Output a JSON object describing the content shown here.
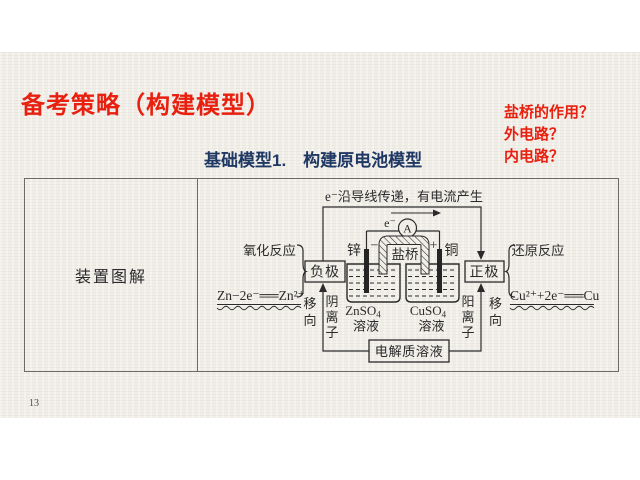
{
  "header": {
    "title": "备考策略（构建模型）"
  },
  "questions": {
    "items": [
      "盐桥的作用？",
      "外电路？",
      "内电路？"
    ]
  },
  "subtitle": {
    "text": "基础模型1.　构建原电池模型"
  },
  "table": {
    "row_label": "装置图解"
  },
  "diagram": {
    "top_caption": "e⁻沿导线传递，有电流产生",
    "electron_label": "e⁻",
    "ammeter_label": "A",
    "zinc_label": "锌",
    "copper_label": "铜",
    "minus_sign": "−",
    "plus_sign": "+",
    "salt_bridge_label": "盐桥",
    "negative_electrode_label": "负极",
    "positive_electrode_label": "正极",
    "oxidation_label": "氧化反应",
    "reduction_label": "还原反应",
    "oxidation_equation": "Zn−2e⁻══Zn²⁺",
    "reduction_equation": "Cu²⁺+2e⁻══Cu",
    "zn_solution_formula": "ZnSO",
    "zn_solution_sub": "4",
    "zn_solution_label": "溶液",
    "cu_solution_formula": "CuSO",
    "cu_solution_sub": "4",
    "cu_solution_label": "溶液",
    "anion_label": "阴离子",
    "cation_label": "阳离子",
    "move_label_left": "移向",
    "move_label_right": "移向",
    "electrolyte_label": "电解质溶液"
  },
  "footer": {
    "page_number": "13"
  },
  "colors": {
    "accent_red": "#e8200f",
    "heading_blue": "#1f3864",
    "slide_background": "#f1eee8",
    "ink": "#2b2b2b"
  }
}
